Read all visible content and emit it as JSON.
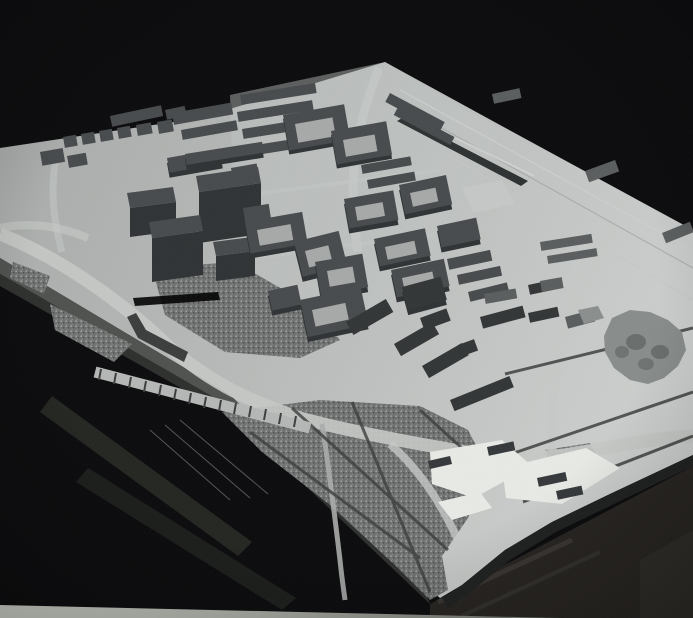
{
  "scene": {
    "title": "Photograph of an architectural urban massing model",
    "description": "Monochrome photo of a physical architectural scale model: a tilted white baseboard on a dark table, covered with dark grey building blocks, perimeter courtyard blocks, a tall tower cluster, speckled park areas with paths, curving roads, a rail corridor and an organic grove-like landmark shape",
    "regions": {
      "tower_cluster": "tall slab towers, centre-left",
      "perimeter_blocks": "courtyard housing blocks, centre",
      "row_housing": "parallel housing rows, top",
      "parks": "speckled park surfaces with paths, lower left and bottom",
      "rail_corridor": "open corridor with track lines, right",
      "landmark": "organic lumpy landmark shape, centre-right",
      "site_pieces": "loose white card pieces, bottom edge"
    }
  },
  "palette": {
    "background": "#0a0a0c",
    "board_dim": "#a9acaa",
    "board_light": "#b8bbb9",
    "board_bright": "#cdd0ce",
    "building_dark": "#474a4c",
    "building_face": "#2f3234",
    "building_light": "#5a5d5e",
    "block_darkest": "#323536",
    "courtyard": "#a6a9a7",
    "texture_base": "#6e7170",
    "texture_fleck_light": "#9da09e",
    "texture_fleck_dark": "#4b4e4c",
    "road": "#c6c9c7",
    "road_minor": "#a9acaa",
    "rail": "#3b3e3d",
    "landmark_blob": "#888c8a",
    "paper": "#e8eae6",
    "bevel": "#4e514e",
    "bevel_dark": "#2d2f2d",
    "edge_shadow": "#1e201f",
    "table": "#262320",
    "table_strip_light": "#d8dcd2",
    "under_edge_band": "#232521"
  }
}
